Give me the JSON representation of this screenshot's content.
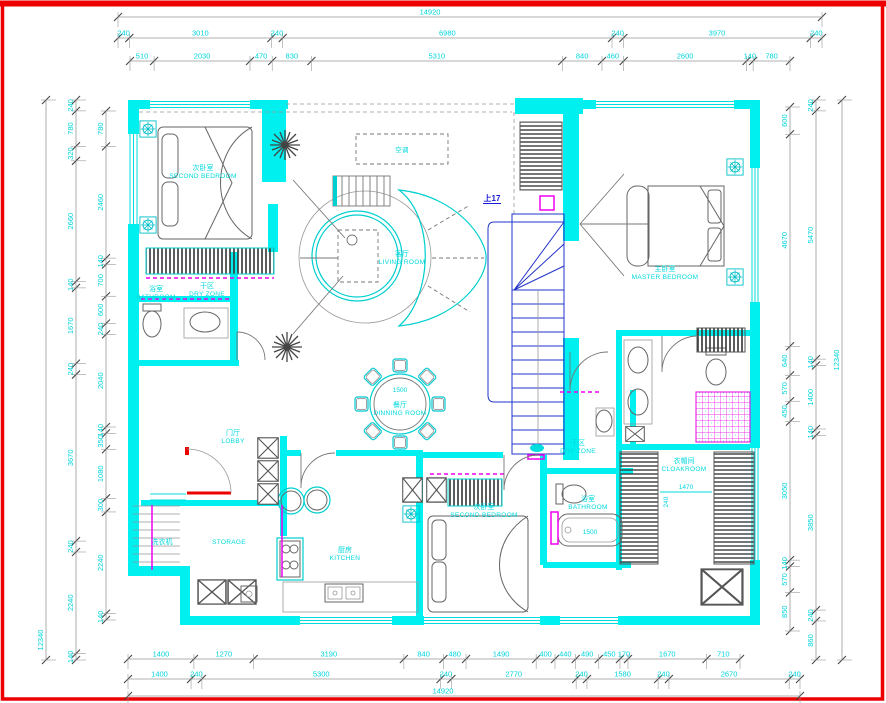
{
  "frame": {
    "border_color": "#EE0000"
  },
  "colors": {
    "wall_cyan": "#00EFEF",
    "text_cyan": "#00D8DE",
    "magenta": "#F000F0",
    "stair_blue": "#2233c8",
    "entry_red": "#EE0000",
    "line_gray": "#666666"
  },
  "plan": {
    "stair_up_label": "上17",
    "ac_label": "空调",
    "labels": {
      "second_bedroom_1": {
        "zh": "次卧室",
        "en": "SECOND BEDROOM"
      },
      "living": {
        "zh": "客厅",
        "en": "LIVING ROOM"
      },
      "master": {
        "zh": "主卧室",
        "en": "MASTER BEDROOM"
      },
      "dining": {
        "zh": "餐厅",
        "en": "DINNING ROOM"
      },
      "kitchen": {
        "zh": "厨房",
        "en": "KITCHEN"
      },
      "lobby": {
        "zh": "门厅",
        "en": "LOBBY"
      },
      "bathroom_1": {
        "zh": "浴室",
        "en": "BATHROOM"
      },
      "dry_zone_1": {
        "zh": "干区",
        "en": "DRY ZONE"
      },
      "bathroom_2": {
        "zh": "浴室",
        "en": "BATHROOM"
      },
      "dry_zone_2": {
        "zh": "干区",
        "en": "DRY ZONE"
      },
      "second_bedroom_2": {
        "zh": "次卧室",
        "en": "SECOND BEDROOM"
      },
      "cloakroom": {
        "zh": "衣帽间",
        "en": "CLOAKROOM"
      },
      "storage": {
        "en": "STORAGE"
      },
      "laundry": {
        "zh": "洗衣机"
      }
    },
    "inline_dims": {
      "dining_table": "1500",
      "bathtub": "1500",
      "cloakroom_width": "1470",
      "cloakroom_depth": "240"
    }
  },
  "dims": {
    "top_overall": [
      "14920"
    ],
    "top_axes": [
      "240",
      "3010",
      "240",
      "6980",
      "240",
      "3970",
      "240"
    ],
    "top_detail": [
      "510",
      "2030",
      "470",
      "830",
      "5310",
      "840",
      "460",
      "2600",
      "140",
      "780"
    ],
    "bottom_detail": [
      "1400",
      "1270",
      "3190",
      "840",
      "480",
      "1490",
      "400",
      "440",
      "490",
      "450",
      "170",
      "1670",
      "710"
    ],
    "bottom_axes": [
      "1400",
      "240",
      "5300",
      "240",
      "2770",
      "240",
      "1580",
      "240",
      "2670",
      "240"
    ],
    "bottom_overall": [
      "14920"
    ],
    "left_overall": [
      "12340"
    ],
    "left_axes": [
      "240",
      "780",
      "320",
      "2660",
      "140",
      "1670",
      "240",
      "3670",
      "240",
      "2240",
      "140"
    ],
    "left_detail": [
      "780",
      "2460",
      "140",
      "700",
      "600",
      "240",
      "2040",
      "140",
      "350",
      "1080",
      "300",
      "2240",
      "140"
    ],
    "right_detail": [
      "600",
      "4670",
      "640",
      "570",
      "450",
      "3050",
      "140",
      "570",
      "850"
    ],
    "right_axes": [
      "240",
      "5470",
      "140",
      "1400",
      "140",
      "3850",
      "240",
      "860"
    ],
    "right_overall": [
      "12340"
    ]
  }
}
